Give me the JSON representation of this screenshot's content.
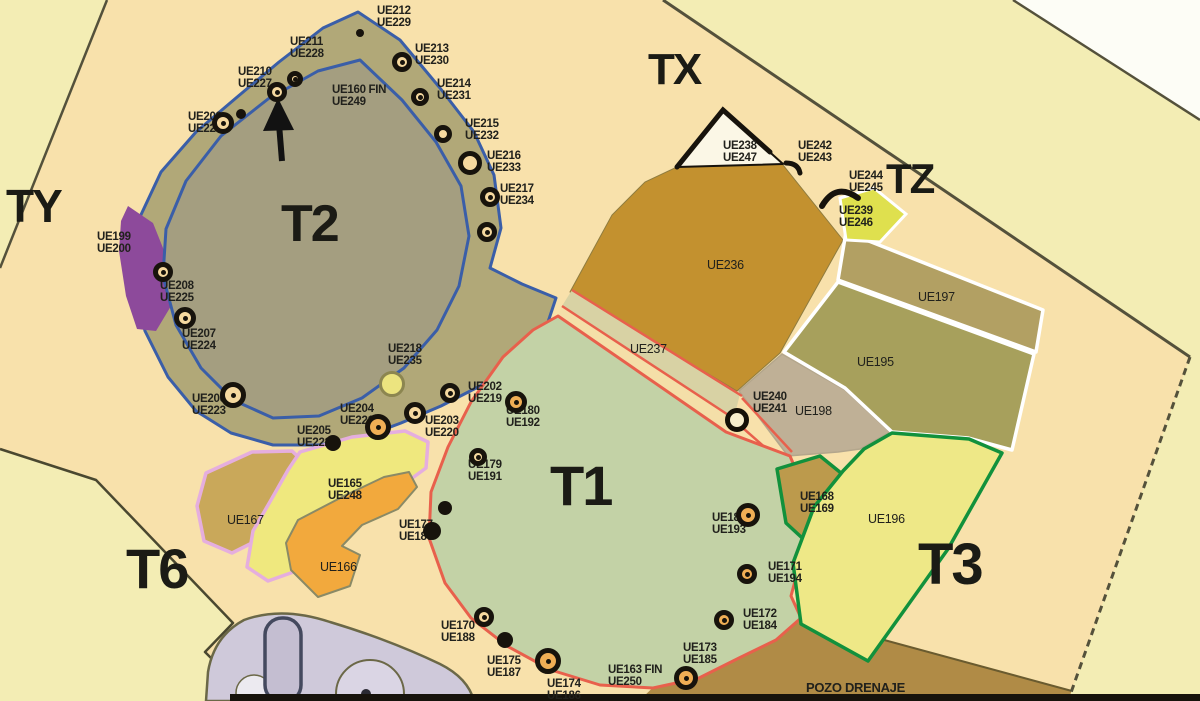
{
  "palette": {
    "peach": "#f8e1ab",
    "pale": "#f3edb4",
    "dark": "#54513b",
    "ink": "#21211c",
    "band": "#b1a878",
    "t2in": "#a49e80",
    "blue": "#3a5ea8",
    "purple": "#8d4a9b",
    "t1": "#c3d2a6",
    "red": "#e8604c",
    "strip": "#d8d2a4",
    "mustard": "#c3912f",
    "ue197": "#b2a063",
    "ue195": "#a7a05c",
    "ue198": "#bfb096",
    "ue196": "#eee887",
    "green": "#12913c",
    "ue168tan": "#bc9a4c",
    "pozo": "#b08b46",
    "ue167tan": "#c9a85a",
    "ue165y": "#efe87e",
    "ue166o": "#f2a93d",
    "pink": "#e5aede",
    "ue239": "#dfe04e",
    "ue238": "#fbf7e6",
    "black": "#17130c",
    "cream": "#f6d99f",
    "orangefill": "#f0ae55",
    "yellowblob": "#ece47f",
    "paleblob": "#f7eecb",
    "lav": "#cfc9da",
    "lavline": "#6b6847"
  },
  "zones": [
    {
      "label": "TY",
      "x": 6,
      "y": 185,
      "fs": 46
    },
    {
      "label": "T2",
      "x": 281,
      "y": 201,
      "fs": 52
    },
    {
      "label": "TX",
      "x": 648,
      "y": 50,
      "fs": 44
    },
    {
      "label": "TZ",
      "x": 886,
      "y": 160,
      "fs": 42
    },
    {
      "label": "T1",
      "x": 550,
      "y": 460,
      "fs": 56
    },
    {
      "label": "T3",
      "x": 918,
      "y": 538,
      "fs": 58
    },
    {
      "label": "T6",
      "x": 126,
      "y": 543,
      "fs": 56
    }
  ],
  "ue_labels": [
    {
      "x": 377,
      "y": 6,
      "lines": [
        "UE212",
        "UE229"
      ]
    },
    {
      "x": 290,
      "y": 37,
      "lines": [
        "UE211",
        "UE228"
      ]
    },
    {
      "x": 238,
      "y": 67,
      "lines": [
        "UE210",
        "UE227"
      ]
    },
    {
      "x": 188,
      "y": 112,
      "lines": [
        "UE209",
        "UE226"
      ]
    },
    {
      "x": 332,
      "y": 85,
      "lines": [
        "UE160 FIN",
        "UE249"
      ]
    },
    {
      "x": 415,
      "y": 44,
      "lines": [
        "UE213",
        "UE230"
      ]
    },
    {
      "x": 437,
      "y": 79,
      "lines": [
        "UE214",
        "UE231"
      ]
    },
    {
      "x": 465,
      "y": 119,
      "lines": [
        "UE215",
        "UE232"
      ]
    },
    {
      "x": 487,
      "y": 151,
      "lines": [
        "UE216",
        "UE233"
      ]
    },
    {
      "x": 500,
      "y": 184,
      "lines": [
        "UE217",
        "UE234"
      ]
    },
    {
      "x": 97,
      "y": 232,
      "lines": [
        "UE199",
        "UE200"
      ]
    },
    {
      "x": 160,
      "y": 281,
      "lines": [
        "UE208",
        "UE225"
      ]
    },
    {
      "x": 182,
      "y": 329,
      "lines": [
        "UE207",
        "UE224"
      ]
    },
    {
      "x": 192,
      "y": 394,
      "lines": [
        "UE206",
        "UE223"
      ]
    },
    {
      "x": 297,
      "y": 426,
      "lines": [
        "UE205",
        "UE222"
      ]
    },
    {
      "x": 340,
      "y": 404,
      "lines": [
        "UE204",
        "UE221"
      ]
    },
    {
      "x": 388,
      "y": 344,
      "lines": [
        "UE218",
        "UE235"
      ]
    },
    {
      "x": 425,
      "y": 416,
      "lines": [
        "UE203",
        "UE220"
      ]
    },
    {
      "x": 468,
      "y": 382,
      "lines": [
        "UE202",
        "UE219"
      ]
    },
    {
      "x": 506,
      "y": 406,
      "lines": [
        "UE180",
        "UE192"
      ]
    },
    {
      "x": 468,
      "y": 460,
      "lines": [
        "UE179",
        "UE191"
      ]
    },
    {
      "x": 399,
      "y": 520,
      "lines": [
        "UE177",
        "UE189"
      ]
    },
    {
      "x": 441,
      "y": 621,
      "lines": [
        "UE170",
        "UE188"
      ]
    },
    {
      "x": 487,
      "y": 656,
      "lines": [
        "UE175",
        "UE187"
      ]
    },
    {
      "x": 547,
      "y": 679,
      "lines": [
        "UE174",
        "UE186"
      ]
    },
    {
      "x": 608,
      "y": 665,
      "lines": [
        "UE163 FIN",
        "UE250"
      ]
    },
    {
      "x": 683,
      "y": 643,
      "lines": [
        "UE173",
        "UE185"
      ]
    },
    {
      "x": 743,
      "y": 609,
      "lines": [
        "UE172",
        "UE184"
      ]
    },
    {
      "x": 768,
      "y": 562,
      "lines": [
        "UE171",
        "UE194"
      ]
    },
    {
      "x": 712,
      "y": 513,
      "lines": [
        "UE181",
        "UE193"
      ]
    },
    {
      "x": 800,
      "y": 492,
      "lines": [
        "UE168",
        "UE169"
      ]
    },
    {
      "x": 227,
      "y": 514,
      "lines": [
        "UE167"
      ],
      "style": "md"
    },
    {
      "x": 328,
      "y": 479,
      "lines": [
        "UE165",
        "UE248"
      ]
    },
    {
      "x": 320,
      "y": 561,
      "lines": [
        "UE166"
      ],
      "style": "md"
    },
    {
      "x": 707,
      "y": 259,
      "lines": [
        "UE236"
      ],
      "style": "md"
    },
    {
      "x": 630,
      "y": 343,
      "lines": [
        "UE237"
      ],
      "style": "md"
    },
    {
      "x": 753,
      "y": 392,
      "lines": [
        "UE240",
        "UE241"
      ]
    },
    {
      "x": 795,
      "y": 405,
      "lines": [
        "UE198"
      ],
      "style": "md"
    },
    {
      "x": 857,
      "y": 356,
      "lines": [
        "UE195"
      ],
      "style": "md"
    },
    {
      "x": 918,
      "y": 291,
      "lines": [
        "UE197"
      ],
      "style": "md"
    },
    {
      "x": 868,
      "y": 513,
      "lines": [
        "UE196"
      ],
      "style": "md"
    },
    {
      "x": 723,
      "y": 141,
      "lines": [
        "UE238",
        "UE247"
      ]
    },
    {
      "x": 798,
      "y": 141,
      "lines": [
        "UE242",
        "UE243"
      ]
    },
    {
      "x": 849,
      "y": 171,
      "lines": [
        "UE244",
        "UE245"
      ]
    },
    {
      "x": 839,
      "y": 206,
      "lines": [
        "UE239",
        "UE246"
      ]
    },
    {
      "x": 806,
      "y": 681,
      "lines": [
        "POZO DRENAJE"
      ],
      "style": "lg"
    }
  ],
  "markers": [
    {
      "x": 360,
      "y": 33,
      "r": 4,
      "t": "dark"
    },
    {
      "x": 402,
      "y": 62,
      "r": 10,
      "t": "cream",
      "dot": 1
    },
    {
      "x": 420,
      "y": 97,
      "r": 9,
      "t": "cream",
      "dot": 1
    },
    {
      "x": 443,
      "y": 134,
      "r": 9,
      "t": "cream"
    },
    {
      "x": 470,
      "y": 163,
      "r": 12,
      "t": "cream"
    },
    {
      "x": 490,
      "y": 197,
      "r": 10,
      "t": "cream",
      "dot": 1
    },
    {
      "x": 487,
      "y": 232,
      "r": 10,
      "t": "cream",
      "dot": 1
    },
    {
      "x": 295,
      "y": 79,
      "r": 8,
      "t": "cream",
      "dot": 1
    },
    {
      "x": 277,
      "y": 92,
      "r": 10,
      "t": "cream",
      "dot": 1
    },
    {
      "x": 223,
      "y": 123,
      "r": 11,
      "t": "cream",
      "dot": 1
    },
    {
      "x": 241,
      "y": 114,
      "r": 5,
      "t": "dark"
    },
    {
      "x": 163,
      "y": 272,
      "r": 10,
      "t": "cream",
      "dot": 1
    },
    {
      "x": 185,
      "y": 318,
      "r": 11,
      "t": "cream",
      "dot": 1
    },
    {
      "x": 233,
      "y": 395,
      "r": 13,
      "t": "cream",
      "dot": 1
    },
    {
      "x": 333,
      "y": 443,
      "r": 8,
      "t": "dark"
    },
    {
      "x": 378,
      "y": 427,
      "r": 13,
      "t": "orange",
      "dot": 1
    },
    {
      "x": 415,
      "y": 413,
      "r": 11,
      "t": "cream",
      "dot": 1
    },
    {
      "x": 450,
      "y": 393,
      "r": 10,
      "t": "cream",
      "dot": 1
    },
    {
      "x": 516,
      "y": 402,
      "r": 11,
      "t": "orange",
      "dot": 1
    },
    {
      "x": 478,
      "y": 457,
      "r": 9,
      "t": "cream",
      "dot": 1
    },
    {
      "x": 445,
      "y": 508,
      "r": 7,
      "t": "dark"
    },
    {
      "x": 432,
      "y": 531,
      "r": 9,
      "t": "dark"
    },
    {
      "x": 484,
      "y": 617,
      "r": 10,
      "t": "cream",
      "dot": 1
    },
    {
      "x": 505,
      "y": 640,
      "r": 8,
      "t": "dark"
    },
    {
      "x": 548,
      "y": 661,
      "r": 13,
      "t": "orange",
      "dot": 1
    },
    {
      "x": 686,
      "y": 678,
      "r": 12,
      "t": "orange",
      "dot": 1
    },
    {
      "x": 724,
      "y": 620,
      "r": 10,
      "t": "orange",
      "dot": 1
    },
    {
      "x": 747,
      "y": 574,
      "r": 10,
      "t": "orange",
      "dot": 1
    },
    {
      "x": 748,
      "y": 515,
      "r": 12,
      "t": "orange",
      "dot": 1
    },
    {
      "x": 392,
      "y": 384,
      "r": 13,
      "t": "yellow"
    },
    {
      "x": 737,
      "y": 420,
      "r": 12,
      "t": "pale"
    }
  ]
}
